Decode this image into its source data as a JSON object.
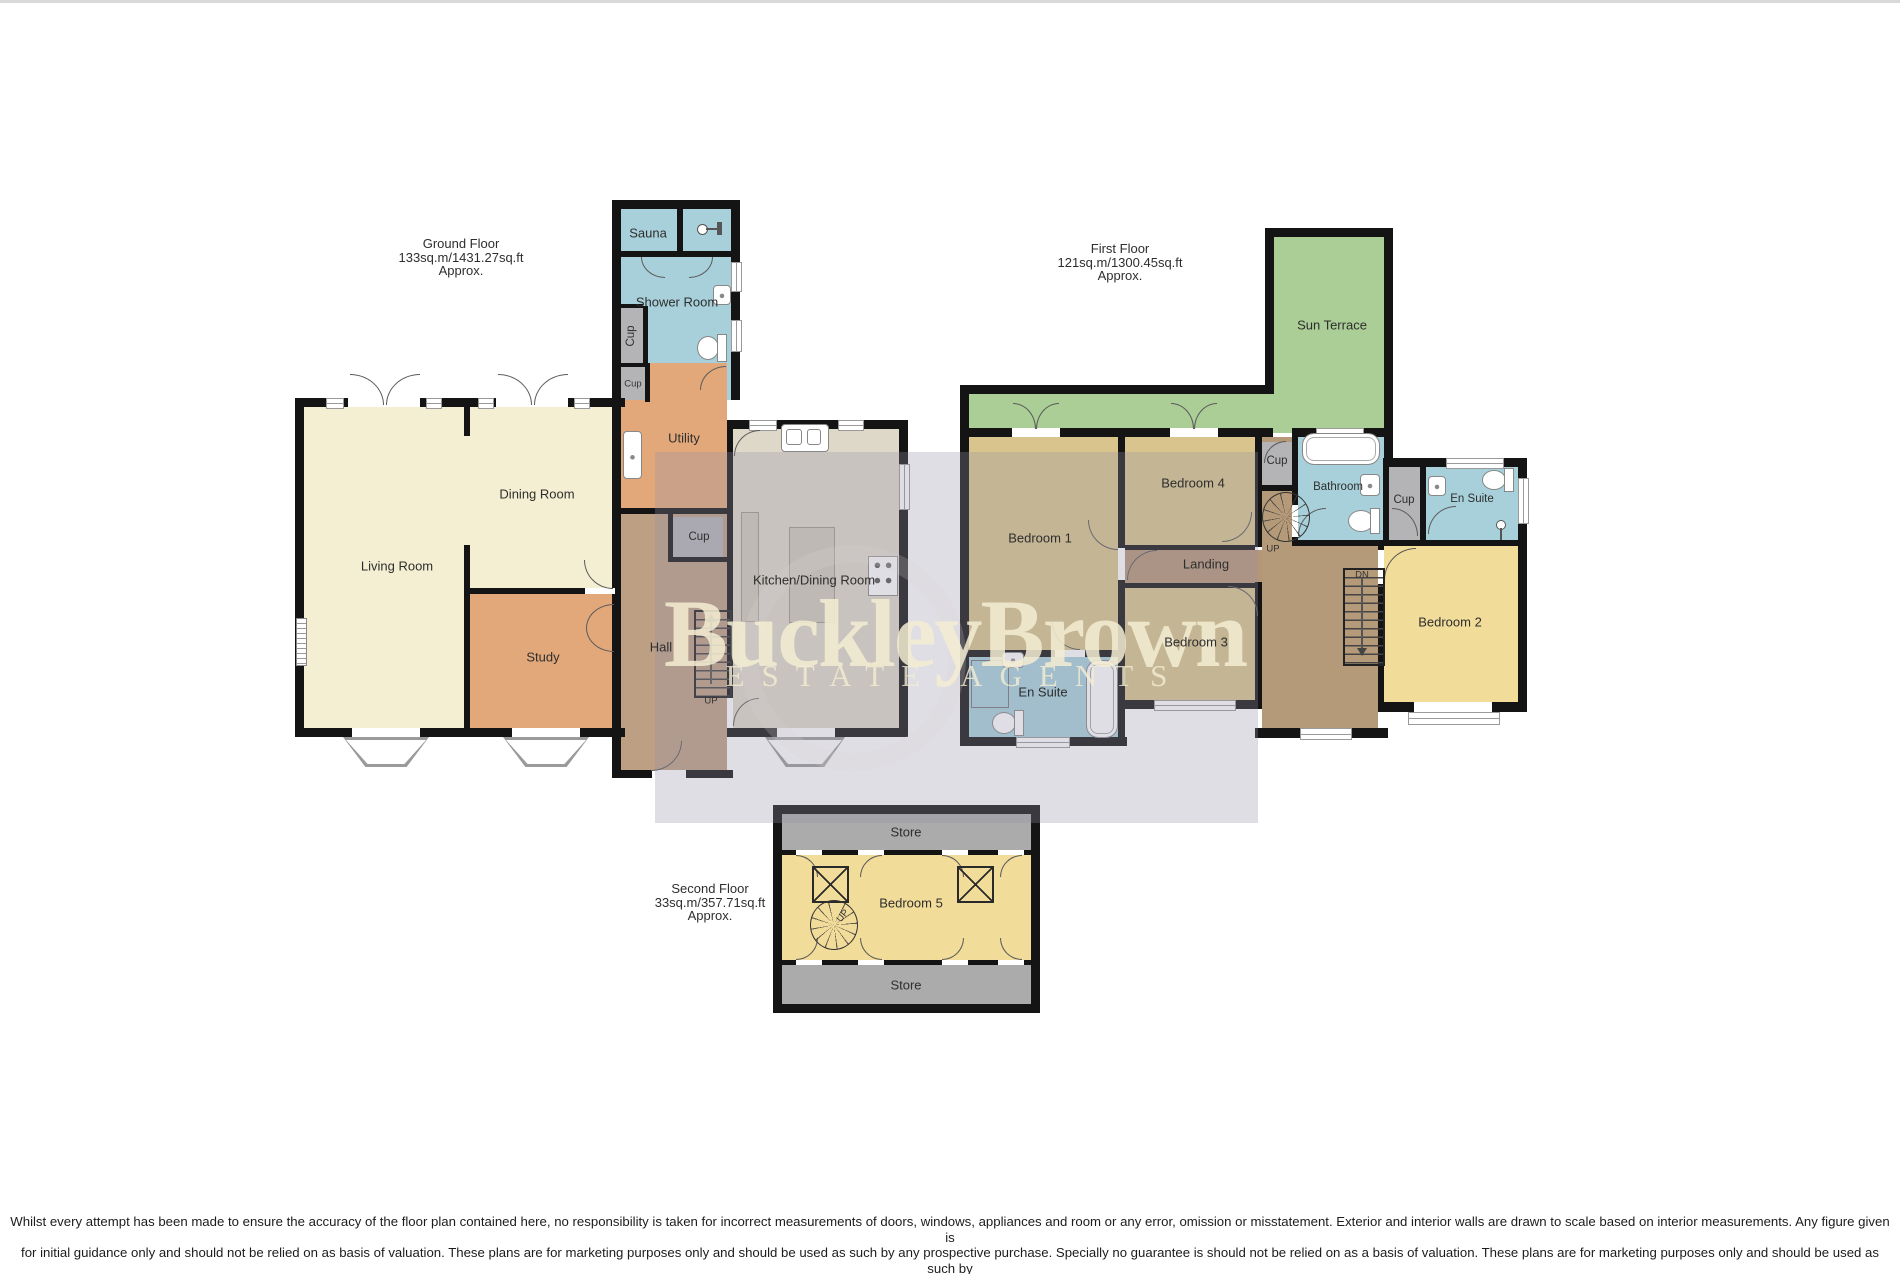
{
  "watermark": {
    "brand": "BuckleyBrown",
    "tagline": "ESTATE AGENTS"
  },
  "floors": {
    "ground": {
      "title": "Ground Floor",
      "area": "133sq.m/1431.27sq.ft",
      "approx": "Approx.",
      "rooms": {
        "living": "Living Room",
        "dining": "Dining Room",
        "study": "Study",
        "hall": "Hall",
        "utility": "Utility",
        "sauna": "Sauna",
        "shower_room": "Shower Room",
        "kitchen": "Kitchen/Dining Room",
        "cup_shower": "Cup",
        "cup_utility": "Cup",
        "cup_hall": "Cup",
        "stairs_up": "UP"
      }
    },
    "first": {
      "title": "First Floor",
      "area": "121sq.m/1300.45sq.ft",
      "approx": "Approx.",
      "rooms": {
        "bedroom1": "Bedroom 1",
        "bedroom2": "Bedroom 2",
        "bedroom3": "Bedroom 3",
        "bedroom4": "Bedroom 4",
        "landing": "Landing",
        "sun_terrace": "Sun Terrace",
        "bathroom": "Bathroom",
        "ensuite_left": "En Suite",
        "ensuite_right": "En Suite",
        "cup_top": "Cup",
        "cup_right": "Cup",
        "stairs_up": "UP",
        "stairs_dn": "DN"
      }
    },
    "second": {
      "title": "Second Floor",
      "area": "33sq.m/357.71sq.ft",
      "approx": "Approx.",
      "rooms": {
        "store_top": "Store",
        "store_bottom": "Store",
        "bedroom5": "Bedroom 5",
        "stairs_up": "UP"
      }
    }
  },
  "footer": {
    "line1": "Whilst every attempt has been made to ensure the accuracy of the floor plan contained here, no responsibility is taken for incorrect measurements of doors, windows, appliances and room or any error, omission or misstatement. Exterior and interior walls are drawn to scale based on interior measurements. Any figure given is",
    "line2": "for initial guidance only and should not be relied on as basis of valuation. These plans are for marketing purposes only and should be used as such by any prospective purchase. Specially no guarantee is should not be relied on as a basis of valuation. These plans are for marketing purposes only and should be used as such by",
    "line3": "any prospective purchase. Specifically no guarantee is given on the total square footage of the property if quoted on this plan.",
    "line4": "CC Ltd ©2018"
  },
  "colors": {
    "wall": "#141414",
    "living_cream": "#f4eed2",
    "study_orange": "#e2a87a",
    "hall_brown": "#bda084",
    "wet_blue": "#a8d0da",
    "cup_gray": "#b4b4b6",
    "kitchen_beige": "#ded8c8",
    "bedroom_khaki": "#d8c48c",
    "bedroom_yellow": "#f2dc9a",
    "terrace_green": "#abcd96",
    "landing_brown": "#b59677",
    "store_gray": "#ababab",
    "watermark_cream": "#f4edd2",
    "watermark_overlay": "#d6d3db"
  }
}
